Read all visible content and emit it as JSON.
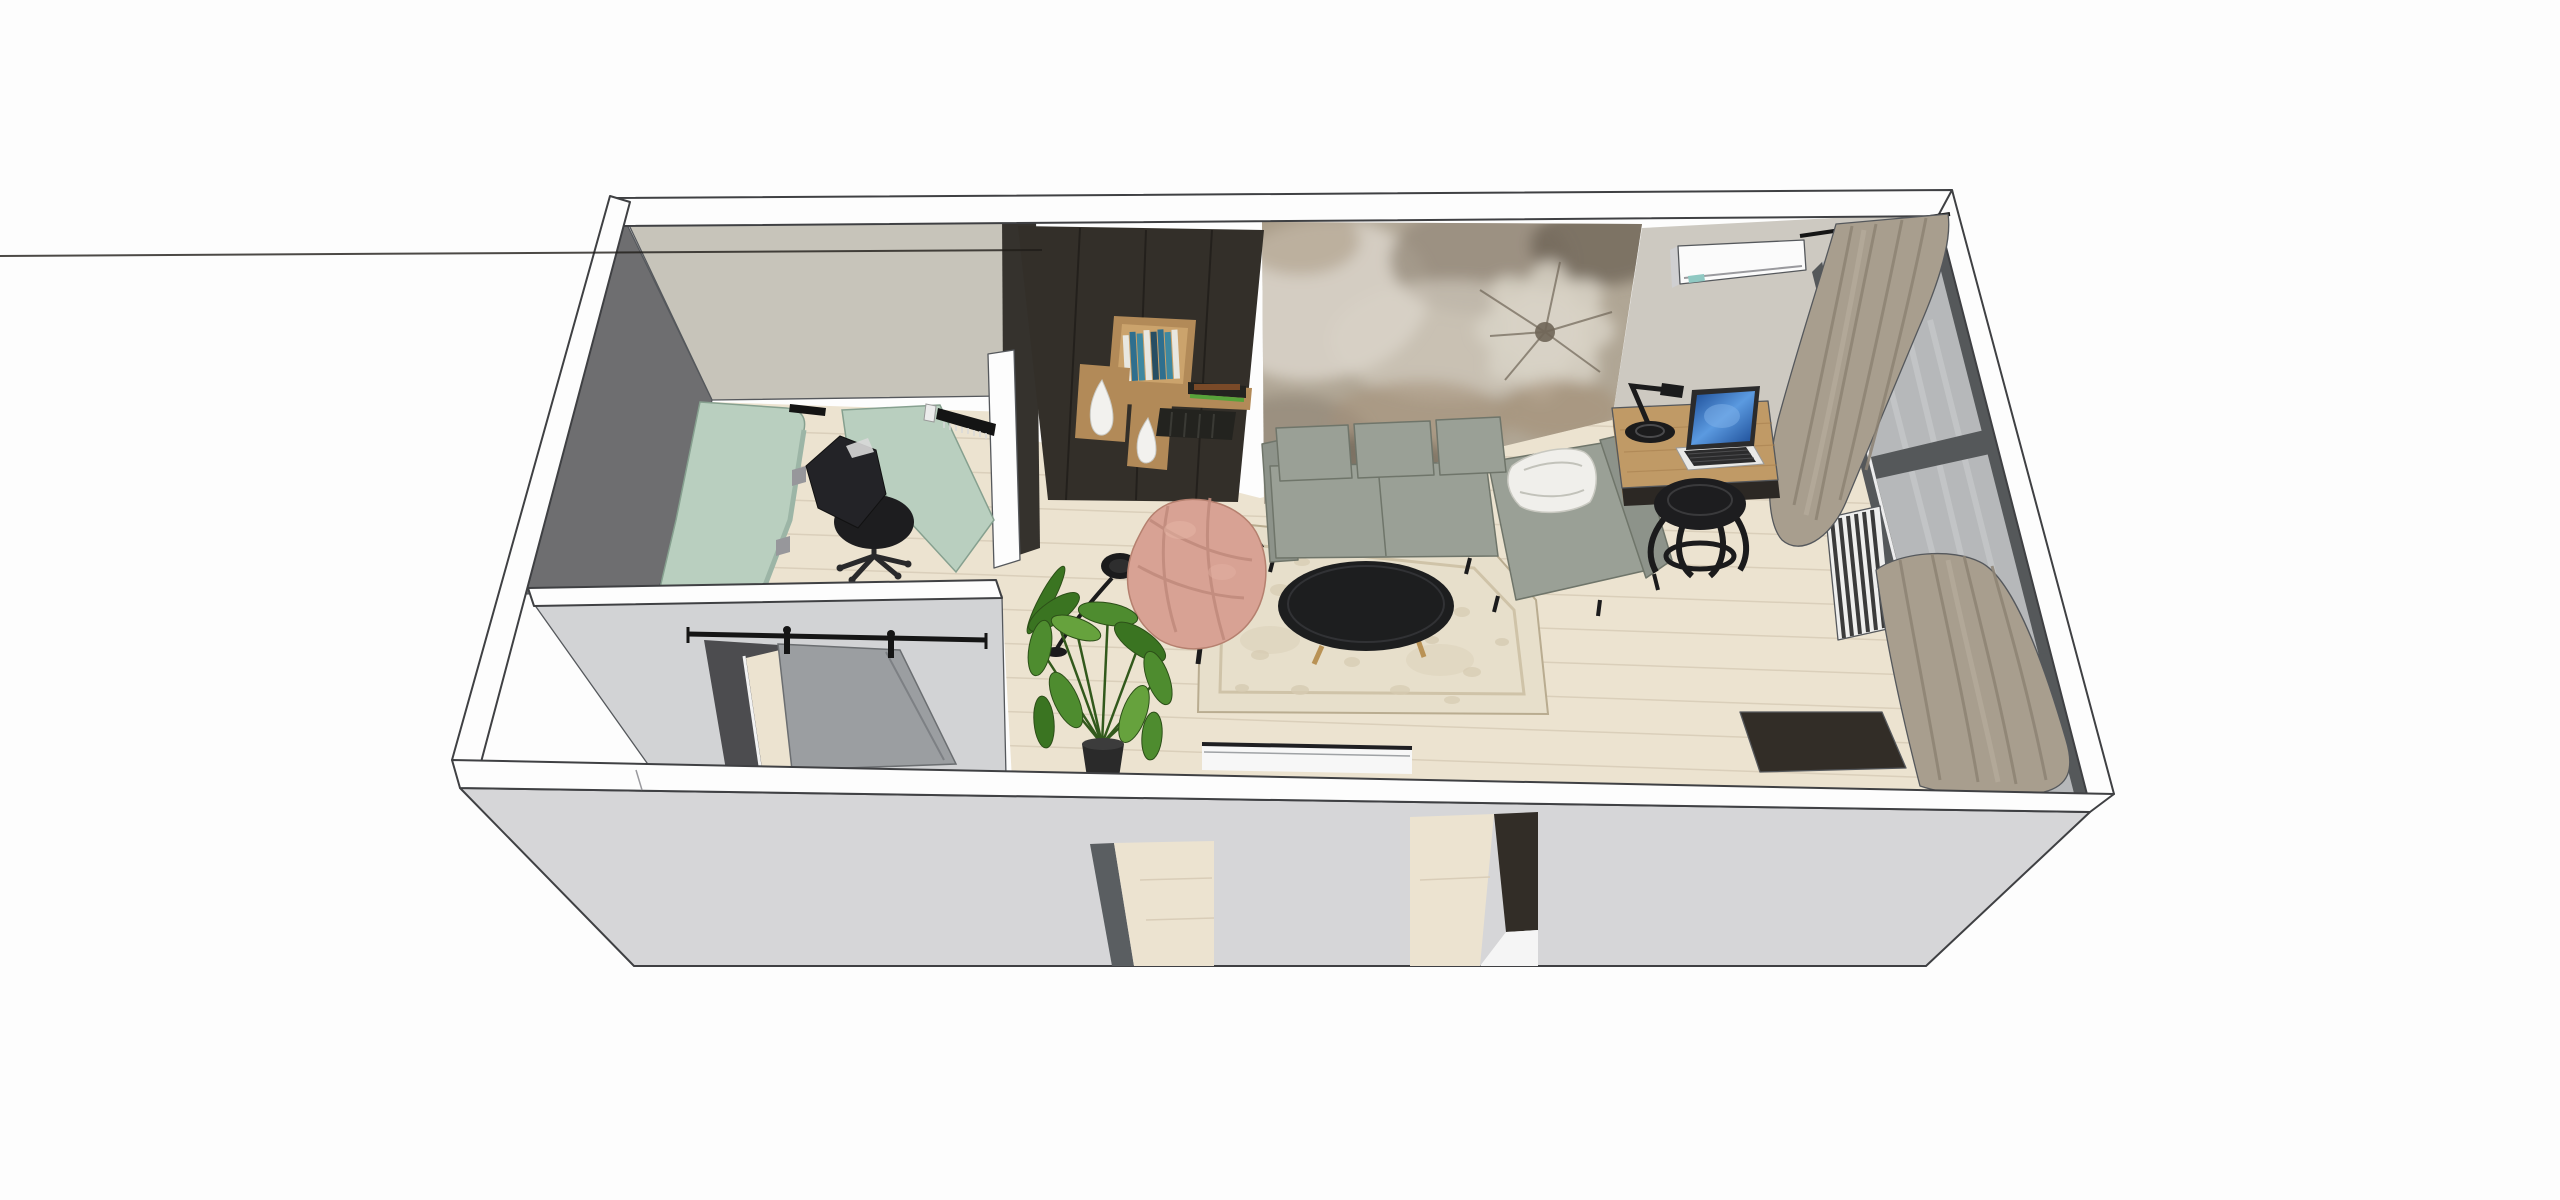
{
  "scene": {
    "type": "3d-interior-axonometric-render",
    "rooms": [
      "home-office",
      "hallway",
      "living-room"
    ],
    "background": "#ffffff"
  },
  "palette": {
    "white": "#fdfdfd",
    "outline": "#3f4043",
    "wall_face_light": "#d6d6d8",
    "wall_face_partition": "#d2d3d5",
    "office_back_wall": "#c7c4ba",
    "office_left_wall": "#6e6e70",
    "office_dark_slab": "#35322d",
    "living_back_wall": "#cdc9c1",
    "floor_wood": "#ece3d0",
    "floor_wood_line": "#d9cdb8",
    "desk_mint": "#b9cfbf",
    "desk_mint_shade": "#9cb5a6",
    "chair_black": "#232327",
    "chair_seat_black": "#1d1d1f",
    "cabinet_dark": "#332f29",
    "cabinet_seam": "#201d19",
    "shelf_wood": "#b28a58",
    "shelf_wood_light": "#cba36c",
    "book_white": "#e8e7e0",
    "book_blue": "#2f6f8e",
    "book_teal": "#3e88a0",
    "book_deep": "#274e63",
    "book_green": "#57a33a",
    "book_dark": "#23231f",
    "vase_white": "#f2f1ee",
    "mural_base": "#b0a695",
    "mural_light": "#d8d2c6",
    "mural_mid": "#978c7d",
    "mural_dark": "#6f6557",
    "mural_brown": "#a5937b",
    "sofa_body": "#9aa096",
    "sofa_shade": "#8d938a",
    "sofa_dark": "#70766b",
    "pillow_white": "#f0efeb",
    "rug_base": "#e7dfcb",
    "rug_border": "#cfc3a8",
    "rug_pattern": "#d6cab1",
    "table_black": "#1d1e1f",
    "table_leg_gold": "#b99255",
    "armchair_pink": "#d8a294",
    "armchair_pink_shade": "#c18b7d",
    "plant_green": "#4e8c2f",
    "plant_green_dark": "#3a7421",
    "plant_green_light": "#66a23d",
    "pot_black": "#2a2a2a",
    "lamp_black": "#1b1b1c",
    "desk_wood": "#c09a66",
    "desk_wood_shade": "#a8814f",
    "desk_front_dark": "#2c2824",
    "laptop_silver": "#e9e9e7",
    "laptop_dark": "#2b2b2c",
    "laptop_screen_deep": "#1a4a94",
    "laptop_screen_light": "#5b9ae0",
    "ac_white": "#fbfbfb",
    "ac_shade": "#cfcfd1",
    "ac_display_teal": "#8fc8c2",
    "curtain_beige": "#a89e8e",
    "curtain_shade": "#8d8374",
    "curtain_light": "#bcb2a2",
    "window_frame": "#55585a",
    "window_glass": "#b6b8ba",
    "glass_streak": "#cdcfd0",
    "radiator_white": "#efefee",
    "radiator_dark": "#3b3b3b",
    "door_gray": "#9b9ea1",
    "door_rail_black": "#151515",
    "door_jamb_dark": "#4c4c4f",
    "threshold_white": "#f7f7f7",
    "jamb_gray": "#5a5e61",
    "sideboard_dark": "#322d27",
    "bracket_gray": "#97979b",
    "strip_black": "#141414",
    "shadow": "#000000"
  },
  "objects": [
    {
      "name": "home-office-desk",
      "color_key": "desk_mint"
    },
    {
      "name": "office-task-chair",
      "color_key": "chair_black"
    },
    {
      "name": "office-wall-shelf",
      "color_key": "strip_black"
    },
    {
      "name": "sliding-barn-door",
      "color_key": "door_gray"
    },
    {
      "name": "media-shelving-unit",
      "color_key": "cabinet_dark"
    },
    {
      "name": "decor-vases",
      "color_key": "vase_white"
    },
    {
      "name": "decor-books",
      "color_key": "book_blue"
    },
    {
      "name": "floral-wall-mural",
      "color_key": "mural_base"
    },
    {
      "name": "sectional-sofa",
      "color_key": "sofa_body"
    },
    {
      "name": "throw-pillow",
      "color_key": "pillow_white"
    },
    {
      "name": "area-rug",
      "color_key": "rug_base"
    },
    {
      "name": "oval-coffee-table",
      "color_key": "table_black"
    },
    {
      "name": "pink-accent-armchair",
      "color_key": "armchair_pink"
    },
    {
      "name": "arc-floor-lamp",
      "color_key": "lamp_black"
    },
    {
      "name": "monstera-plant",
      "color_key": "plant_green"
    },
    {
      "name": "work-desk",
      "color_key": "desk_wood"
    },
    {
      "name": "desk-lamp",
      "color_key": "lamp_black"
    },
    {
      "name": "laptop",
      "color_key": "laptop_screen_light"
    },
    {
      "name": "desk-stool",
      "color_key": "chair_seat_black"
    },
    {
      "name": "air-conditioner",
      "color_key": "ac_white"
    },
    {
      "name": "window-wall",
      "color_key": "window_glass"
    },
    {
      "name": "curtains",
      "color_key": "curtain_beige"
    },
    {
      "name": "radiator",
      "color_key": "radiator_white"
    },
    {
      "name": "sideboard",
      "color_key": "sideboard_dark"
    }
  ]
}
